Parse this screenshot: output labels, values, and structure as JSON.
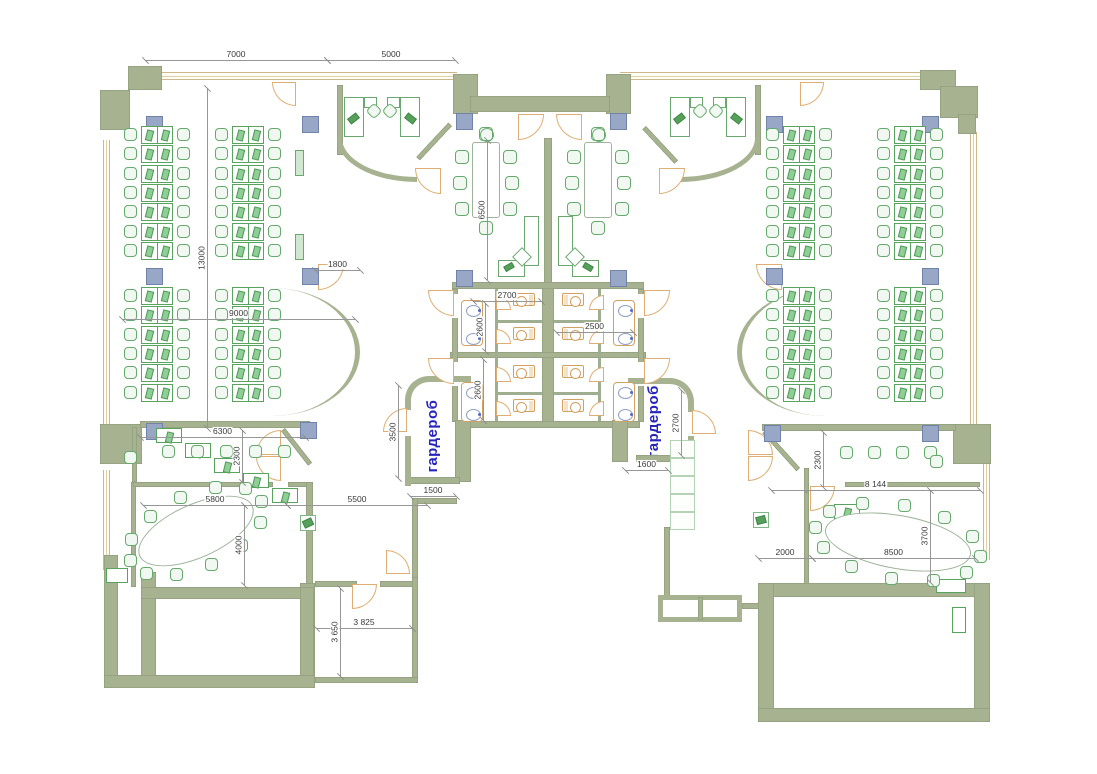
{
  "meta": {
    "drawing_type": "office floor plan"
  },
  "colors": {
    "wall": "#a6b290",
    "column": "#98a7c6",
    "furniture_green": "#58a35e",
    "door_tan": "#dfae74",
    "dimension_gray": "#979797",
    "room_label_blue": "#2626bd",
    "background": "#ffffff"
  },
  "texts": {
    "wardrobe_left": "гардероб",
    "wardrobe_right": "гардероб"
  },
  "dimensions": [
    {
      "id": "top-7000",
      "v": "7000",
      "o": "h",
      "x1": 145,
      "x2": 327,
      "y": 60
    },
    {
      "id": "top-5000",
      "v": "5000",
      "o": "h",
      "x1": 327,
      "x2": 455,
      "y": 60
    },
    {
      "id": "left-13000",
      "v": "13000",
      "o": "v",
      "x": 207,
      "y1": 88,
      "y2": 428
    },
    {
      "id": "left-9000",
      "v": "9000",
      "o": "h",
      "x1": 122,
      "x2": 355,
      "y": 319
    },
    {
      "id": "center-1800",
      "v": "1800",
      "o": "h",
      "x1": 315,
      "x2": 360,
      "y": 270
    },
    {
      "id": "lobby-6500",
      "v": "6500",
      "o": "v",
      "x": 487,
      "y1": 140,
      "y2": 280
    },
    {
      "id": "wc-2700",
      "v": "2700",
      "o": "h",
      "x1": 473,
      "x2": 541,
      "y": 301
    },
    {
      "id": "wc-2600a",
      "v": "2600",
      "o": "v",
      "x": 485,
      "y1": 303,
      "y2": 351
    },
    {
      "id": "wc-2500",
      "v": "2500",
      "o": "h",
      "x1": 556,
      "x2": 633,
      "y": 332
    },
    {
      "id": "wc-2600b",
      "v": "2600",
      "o": "v",
      "x": 483,
      "y1": 359,
      "y2": 420
    },
    {
      "id": "wardrobe-left-3500",
      "v": "3500",
      "o": "v",
      "x": 398,
      "y1": 385,
      "y2": 478
    },
    {
      "id": "wardrobe-left-1500",
      "v": "1500",
      "o": "h",
      "x1": 410,
      "x2": 456,
      "y": 496
    },
    {
      "id": "wardrobe-right-2700",
      "v": "2700",
      "o": "v",
      "x": 681,
      "y1": 390,
      "y2": 455
    },
    {
      "id": "wardrobe-right-1600",
      "v": "1600",
      "o": "h",
      "x1": 625,
      "x2": 668,
      "y": 470
    },
    {
      "id": "bl-6300",
      "v": "6300",
      "o": "h",
      "x1": 140,
      "x2": 305,
      "y": 437
    },
    {
      "id": "bl-2300",
      "v": "2300",
      "o": "v",
      "x": 242,
      "y1": 430,
      "y2": 482
    },
    {
      "id": "bl-5800",
      "v": "5800",
      "o": "h",
      "x1": 143,
      "x2": 287,
      "y": 505
    },
    {
      "id": "bl-5500",
      "v": "5500",
      "o": "h",
      "x1": 287,
      "x2": 427,
      "y": 505
    },
    {
      "id": "bl-4000",
      "v": "4000",
      "o": "v",
      "x": 244,
      "y1": 505,
      "y2": 585
    },
    {
      "id": "bm-3825",
      "v": "3 825",
      "o": "h",
      "x1": 316,
      "x2": 412,
      "y": 628
    },
    {
      "id": "bm-3650",
      "v": "3 650",
      "o": "v",
      "x": 340,
      "y1": 588,
      "y2": 676
    },
    {
      "id": "br-8144",
      "v": "8 144",
      "o": "h",
      "x1": 771,
      "x2": 980,
      "y": 490
    },
    {
      "id": "br-2300",
      "v": "2300",
      "o": "v",
      "x": 823,
      "y1": 432,
      "y2": 487
    },
    {
      "id": "br-2000",
      "v": "2000",
      "o": "h",
      "x1": 758,
      "x2": 812,
      "y": 558
    },
    {
      "id": "br-8500",
      "v": "8500",
      "o": "h",
      "x1": 812,
      "x2": 975,
      "y": 558
    },
    {
      "id": "br-3700",
      "v": "3700",
      "o": "v",
      "x": 930,
      "y1": 490,
      "y2": 582
    }
  ],
  "columns": [
    [
      146,
      116
    ],
    [
      302,
      116
    ],
    [
      456,
      113
    ],
    [
      610,
      113
    ],
    [
      766,
      116
    ],
    [
      922,
      116
    ],
    [
      146,
      268
    ],
    [
      302,
      268
    ],
    [
      456,
      270
    ],
    [
      610,
      270
    ],
    [
      766,
      268
    ],
    [
      922,
      268
    ],
    [
      146,
      423
    ],
    [
      300,
      422
    ],
    [
      764,
      425
    ],
    [
      922,
      425
    ]
  ],
  "desk_banks": [
    {
      "x": 124,
      "y": 126,
      "rows": 7
    },
    {
      "x": 215,
      "y": 126,
      "rows": 7
    },
    {
      "x": 124,
      "y": 287,
      "rows": 6
    },
    {
      "x": 215,
      "y": 287,
      "rows": 6
    },
    {
      "x": 766,
      "y": 126,
      "rows": 7
    },
    {
      "x": 877,
      "y": 126,
      "rows": 7
    },
    {
      "x": 766,
      "y": 287,
      "rows": 6
    },
    {
      "x": 877,
      "y": 287,
      "rows": 6
    }
  ],
  "bottom_desk_rows": [
    {
      "y": 428,
      "xs": [
        156,
        185,
        214,
        243,
        272
      ]
    },
    {
      "y": 429,
      "xs": [
        834,
        862,
        890,
        918
      ]
    }
  ],
  "extra_desks": [
    [
      106,
      433,
      22,
      15
    ],
    [
      936,
      429,
      30,
      14
    ],
    [
      952,
      443,
      14,
      26
    ]
  ],
  "extra_chairs": [
    [
      124,
      451
    ],
    [
      930,
      455
    ]
  ],
  "meeting_tables": [
    {
      "x": 472,
      "y": 142,
      "w": 28,
      "h": 76,
      "chairs": [
        [
          479,
          127
        ],
        [
          479,
          221
        ],
        [
          455,
          150
        ],
        [
          453,
          176
        ],
        [
          455,
          202
        ],
        [
          503,
          150
        ],
        [
          505,
          176
        ],
        [
          503,
          202
        ]
      ]
    },
    {
      "x": 584,
      "y": 142,
      "w": 28,
      "h": 76,
      "chairs": [
        [
          591,
          127
        ],
        [
          591,
          221
        ],
        [
          567,
          150
        ],
        [
          565,
          176
        ],
        [
          567,
          202
        ],
        [
          615,
          150
        ],
        [
          617,
          176
        ],
        [
          615,
          202
        ]
      ]
    }
  ],
  "oval_tables": [
    {
      "cx": 196,
      "cy": 531,
      "rx": 62,
      "ry": 27,
      "rot": -24,
      "chairs": 12
    },
    {
      "cx": 898,
      "cy": 542,
      "rx": 74,
      "ry": 27,
      "rot": 10,
      "chairs": 12
    }
  ],
  "toilets": {
    "rows": [
      293,
      327,
      365,
      399
    ],
    "left_x": 513,
    "right_x": 562
  },
  "sinks": [
    {
      "x": 461,
      "y": 300,
      "h": 46,
      "n": 2
    },
    {
      "x": 461,
      "y": 382,
      "h": 40,
      "n": 2
    },
    {
      "x": 613,
      "y": 300,
      "h": 46,
      "n": 2
    },
    {
      "x": 613,
      "y": 382,
      "h": 40,
      "n": 2
    }
  ],
  "exec_offices": [
    {
      "x": 344,
      "y": 95
    },
    {
      "x": 670,
      "y": 95
    }
  ],
  "plants": [
    {
      "x": 300,
      "y": 515,
      "r": -25
    },
    {
      "x": 753,
      "y": 512,
      "r": -15
    }
  ],
  "wall_items": [
    [
      295,
      150
    ],
    [
      295,
      234
    ]
  ],
  "entry_rings": [
    [
      480,
      128
    ],
    [
      592,
      128
    ]
  ],
  "shelf": {
    "x": 670,
    "y": 440,
    "cell_w": 25,
    "cell_h": 18,
    "cells": 5
  }
}
